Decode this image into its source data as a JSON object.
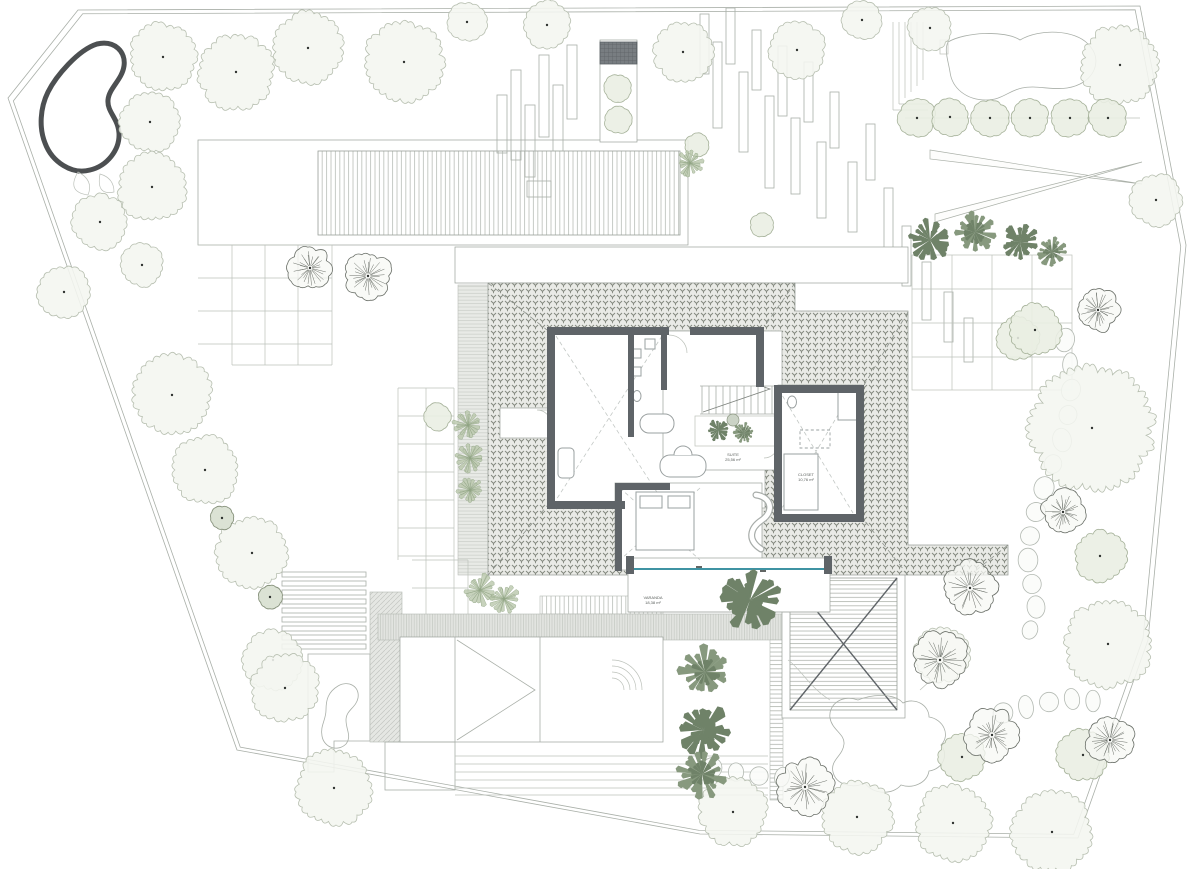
{
  "drawing": {
    "type": "architectural-site-plan",
    "labels": {
      "varanda": {
        "name": "VARANDA",
        "area": "18,38 m²"
      },
      "suite": {
        "name": "SUITE",
        "area": "25,56 m²"
      },
      "closet": {
        "name": "CLOSET",
        "area": "10,76 m²"
      }
    }
  },
  "palette": {
    "wall": "#5f6468",
    "roof_tile_bg": "#e9eae6",
    "roof_tile_mark": "#84897f",
    "glass_accent": "#3f93a3",
    "pool_stroke": "#4c4f51",
    "boundary": "#8f958f",
    "tree_light_fill": "#f4f6f0",
    "tree_light_stroke": "#b7bfb0",
    "tree_green_fill": "#e9eee2",
    "tree_green_stroke": "#a6b29a",
    "shrub_dark_fill": "#dbe2d4",
    "shrub_dark_stroke": "#87927c",
    "palm_dark": "#6f8268",
    "palm_mid": "#87997e",
    "fern": "#b9c7ab",
    "fern_stroke": "#8fa383",
    "sketch_stroke": "#6b7069",
    "stone_stroke": "#b3b9b2",
    "dot": "#2f3330"
  },
  "plants": {
    "trees": [
      [
        163,
        57,
        34,
        "w"
      ],
      [
        236,
        72,
        38,
        "w"
      ],
      [
        308,
        48,
        36,
        "w"
      ],
      [
        404,
        62,
        40,
        "w"
      ],
      [
        467,
        22,
        20,
        "w"
      ],
      [
        547,
        25,
        24,
        "w"
      ],
      [
        683,
        52,
        30,
        "w"
      ],
      [
        797,
        50,
        28,
        "w"
      ],
      [
        862,
        20,
        20,
        "w"
      ],
      [
        930,
        28,
        22,
        "w"
      ],
      [
        1120,
        65,
        40,
        "w"
      ],
      [
        150,
        122,
        30,
        "w"
      ],
      [
        152,
        187,
        34,
        "w"
      ],
      [
        100,
        222,
        28,
        "w"
      ],
      [
        142,
        265,
        22,
        "w"
      ],
      [
        64,
        292,
        26,
        "w"
      ],
      [
        172,
        395,
        40,
        "w"
      ],
      [
        205,
        470,
        34,
        "w"
      ],
      [
        252,
        553,
        36,
        "w"
      ],
      [
        273,
        660,
        30,
        "w"
      ],
      [
        285,
        688,
        34,
        "w"
      ],
      [
        334,
        788,
        38,
        "w"
      ],
      [
        917,
        118,
        19,
        "g"
      ],
      [
        950,
        117,
        19,
        "g"
      ],
      [
        990,
        118,
        19,
        "g"
      ],
      [
        1030,
        118,
        19,
        "g"
      ],
      [
        1070,
        118,
        19,
        "g"
      ],
      [
        1108,
        118,
        19,
        "g"
      ],
      [
        1018,
        338,
        22,
        "g"
      ],
      [
        1092,
        428,
        62,
        "w"
      ],
      [
        1100,
        556,
        26,
        "g"
      ],
      [
        1156,
        200,
        26,
        "w"
      ],
      [
        942,
        654,
        28,
        "w"
      ],
      [
        1108,
        644,
        44,
        "w"
      ],
      [
        962,
        757,
        24,
        "g"
      ],
      [
        1083,
        755,
        26,
        "g"
      ],
      [
        733,
        812,
        34,
        "w"
      ],
      [
        857,
        817,
        36,
        "w"
      ],
      [
        953,
        823,
        38,
        "w"
      ],
      [
        1052,
        832,
        40,
        "w"
      ],
      [
        697,
        145,
        12,
        "g"
      ],
      [
        762,
        225,
        12,
        "g"
      ],
      [
        618,
        88,
        14,
        "g"
      ],
      [
        618,
        120,
        14,
        "g"
      ],
      [
        437,
        417,
        14,
        "g"
      ],
      [
        1035,
        330,
        26,
        "g"
      ]
    ],
    "shrubs_small": [
      [
        222,
        518,
        12
      ],
      [
        270,
        597,
        12
      ]
    ],
    "sketch_trees": [
      [
        310,
        268,
        20
      ],
      [
        368,
        276,
        22
      ],
      [
        1098,
        310,
        20
      ],
      [
        1063,
        512,
        20
      ],
      [
        970,
        588,
        25
      ],
      [
        940,
        660,
        26
      ],
      [
        992,
        735,
        24
      ],
      [
        805,
        787,
        26
      ],
      [
        1110,
        740,
        22
      ]
    ],
    "palms": [
      [
        750,
        600,
        30
      ],
      [
        705,
        672,
        26
      ],
      [
        703,
        730,
        27
      ],
      [
        702,
        774,
        25
      ],
      [
        930,
        240,
        21
      ],
      [
        975,
        232,
        21
      ],
      [
        1020,
        242,
        19
      ],
      [
        1052,
        252,
        15
      ],
      [
        718,
        430,
        11
      ],
      [
        744,
        433,
        11
      ]
    ],
    "ferns": [
      [
        468,
        425,
        15
      ],
      [
        470,
        458,
        14
      ],
      [
        470,
        490,
        13
      ],
      [
        480,
        590,
        16
      ],
      [
        504,
        599,
        15
      ],
      [
        690,
        163,
        13
      ]
    ],
    "stones": [
      [
        1065,
        340
      ],
      [
        1070,
        364
      ],
      [
        1071,
        390
      ],
      [
        1068,
        415
      ],
      [
        1062,
        440
      ],
      [
        1053,
        464
      ],
      [
        1044,
        488
      ],
      [
        1036,
        512
      ],
      [
        1030,
        536
      ],
      [
        1028,
        560
      ],
      [
        1032,
        584
      ],
      [
        1036,
        607
      ],
      [
        1030,
        630
      ],
      [
        1003,
        713
      ],
      [
        1026,
        707
      ],
      [
        1049,
        702
      ],
      [
        1072,
        699
      ],
      [
        1093,
        701
      ],
      [
        712,
        768
      ],
      [
        736,
        772
      ],
      [
        759,
        776
      ],
      [
        782,
        777
      ]
    ]
  }
}
